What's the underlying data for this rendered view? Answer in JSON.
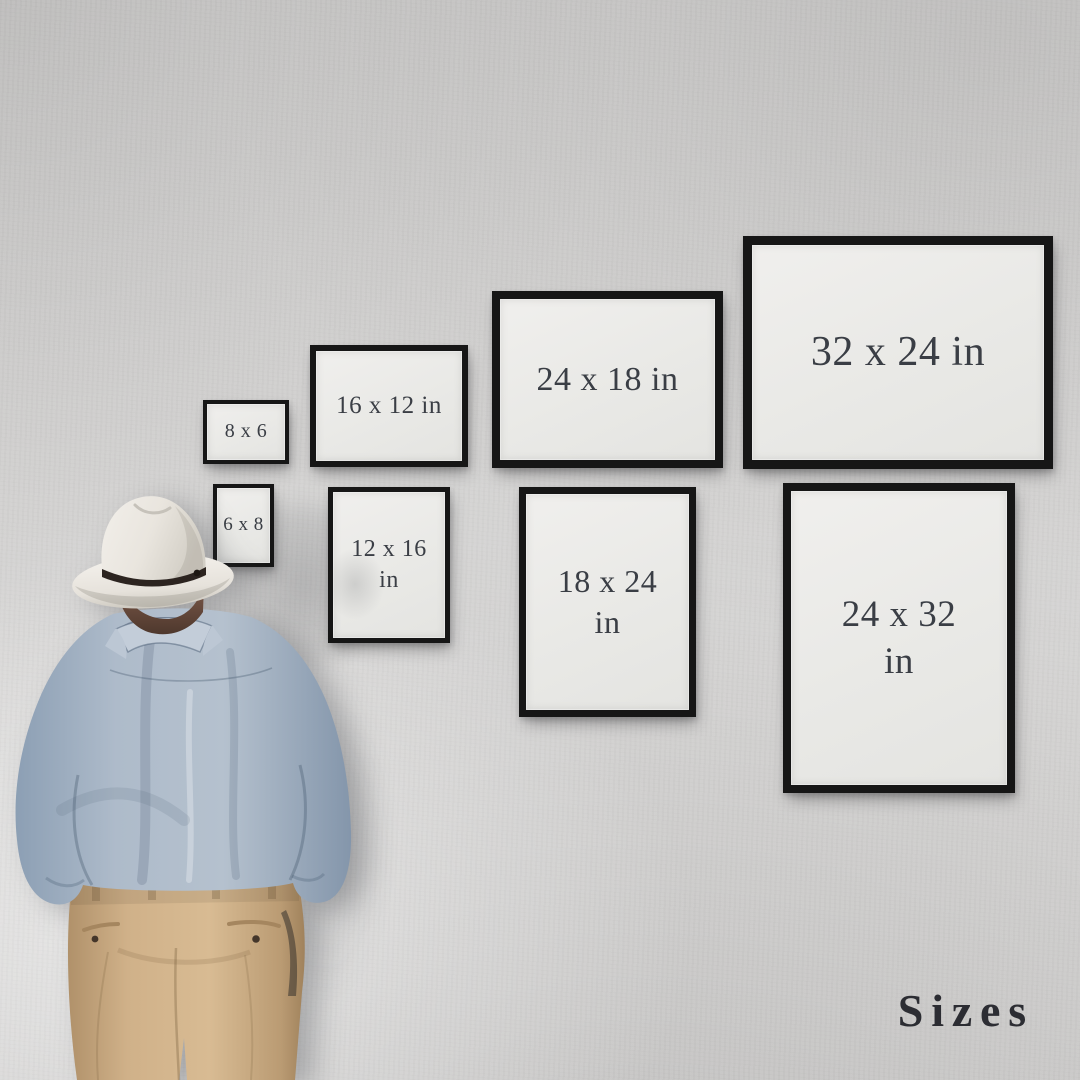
{
  "scene": {
    "title": "Sizes",
    "description": "Man in a white hat and blue shirt seen from behind, looking at framed print-size mockups on a gray wall",
    "colors": {
      "wall": "#d3d2d1",
      "frame_border": "#161616",
      "frame_mat": "#e9e9e6",
      "label_text": "#3a3e45",
      "title_text": "#2c2d33",
      "hat": "#ebe8e2",
      "hat_band": "#2c2420",
      "hair": "#6b4c3e",
      "shirt": "#aebbca",
      "trousers": "#d0b189"
    }
  },
  "frames": [
    {
      "id": "8x6",
      "lines": [
        "8 x 6"
      ],
      "orientation": "landscape",
      "x": 203,
      "y": 400,
      "w": 86,
      "h": 64,
      "border": 4,
      "font": 20
    },
    {
      "id": "16x12",
      "lines": [
        "16 x 12 in"
      ],
      "orientation": "landscape",
      "x": 310,
      "y": 345,
      "w": 158,
      "h": 122,
      "border": 6,
      "font": 25
    },
    {
      "id": "24x18",
      "lines": [
        "24 x 18 in"
      ],
      "orientation": "landscape",
      "x": 492,
      "y": 291,
      "w": 231,
      "h": 177,
      "border": 8,
      "font": 34
    },
    {
      "id": "32x24",
      "lines": [
        "32 x 24 in"
      ],
      "orientation": "landscape",
      "x": 743,
      "y": 236,
      "w": 310,
      "h": 233,
      "border": 9,
      "font": 42
    },
    {
      "id": "6x8",
      "lines": [
        "6 x 8"
      ],
      "orientation": "portrait",
      "x": 213,
      "y": 484,
      "w": 61,
      "h": 83,
      "border": 4,
      "font": 19
    },
    {
      "id": "12x16",
      "lines": [
        "12 x 16",
        "in"
      ],
      "orientation": "portrait",
      "x": 328,
      "y": 487,
      "w": 122,
      "h": 156,
      "border": 5,
      "font": 24
    },
    {
      "id": "18x24",
      "lines": [
        "18 x 24",
        "in"
      ],
      "orientation": "portrait",
      "x": 519,
      "y": 487,
      "w": 177,
      "h": 230,
      "border": 7,
      "font": 32
    },
    {
      "id": "24x32",
      "lines": [
        "24 x 32",
        "in"
      ],
      "orientation": "portrait",
      "x": 783,
      "y": 483,
      "w": 232,
      "h": 310,
      "border": 8,
      "font": 37
    }
  ]
}
